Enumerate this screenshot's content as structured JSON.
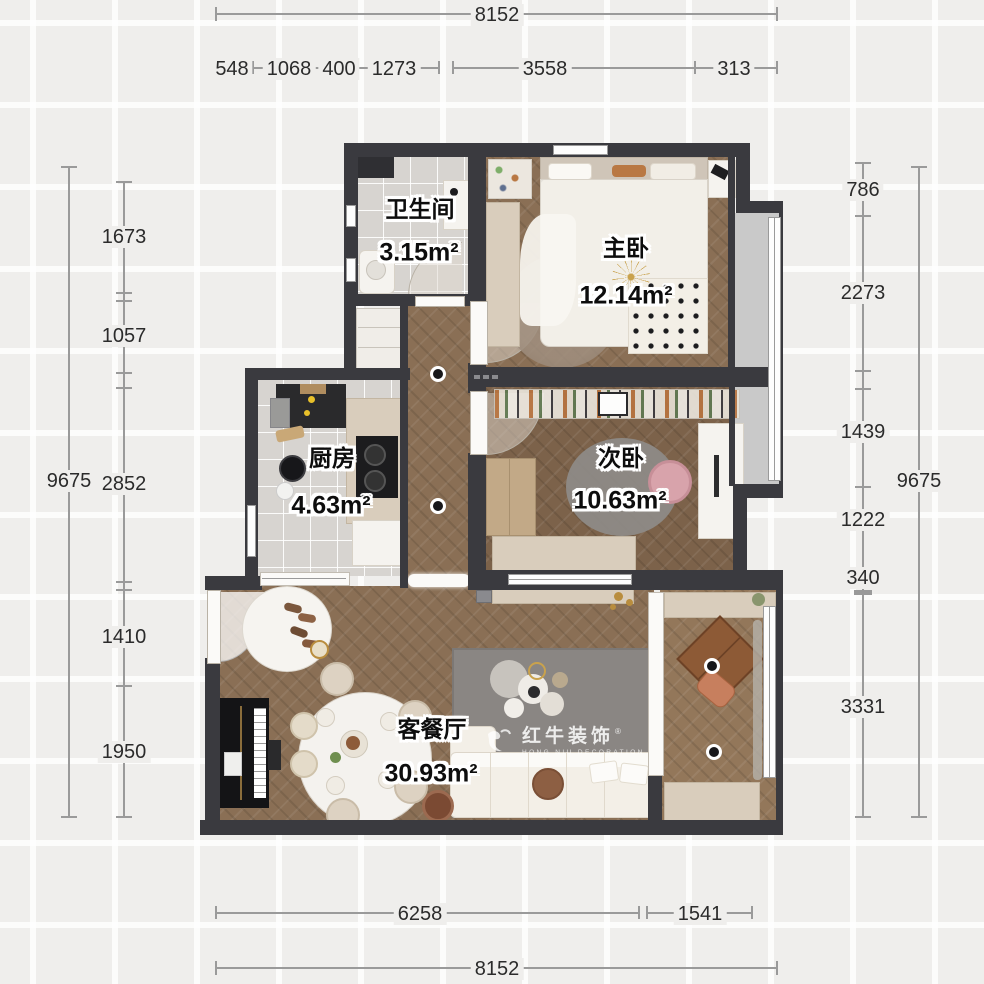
{
  "dims": {
    "top_total": "8152",
    "top_sub": [
      "548",
      "1068",
      "400",
      "1273",
      "3558",
      "313"
    ],
    "bottom_sub": [
      "6258",
      "1541"
    ],
    "bottom_total": "8152",
    "left_total": "9675",
    "left_sub": [
      "1673",
      "1057",
      "2852",
      "1410",
      "1950"
    ],
    "right_sub": [
      "786",
      "2273",
      "1439",
      "1222",
      "340",
      "3331"
    ],
    "right_total": "9675"
  },
  "rooms": [
    {
      "name": "卫生间",
      "area": "3.15m²"
    },
    {
      "name": "主卧",
      "area": "12.14m²"
    },
    {
      "name": "厨房",
      "area": "4.63m²"
    },
    {
      "name": "次卧",
      "area": "10.63m²"
    },
    {
      "name": "客餐厅",
      "area": "30.93m²"
    }
  ],
  "watermark": {
    "brand": "红牛装饰",
    "sub": "HONG NIU DECORATION",
    "reg": "®"
  },
  "colors": {
    "wall": "#3a3a3f",
    "dim_line": "#9a9a9a",
    "dim_text": "#2b2b2b",
    "accent_beige": "#d9cdbc"
  }
}
